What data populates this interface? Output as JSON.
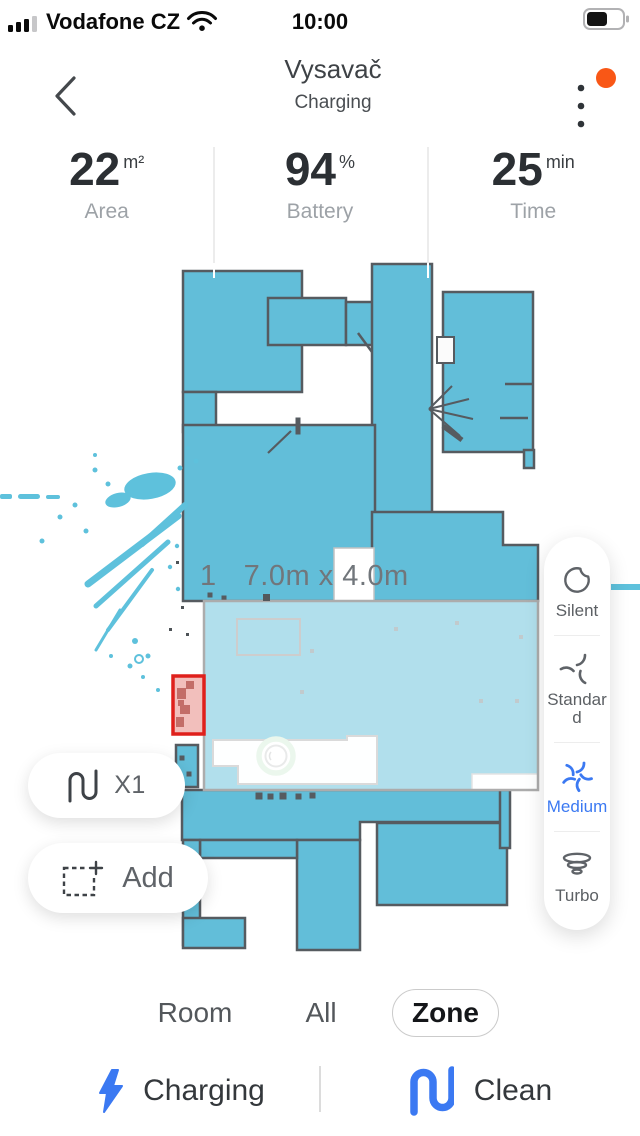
{
  "status_bar": {
    "carrier": "Vodafone CZ",
    "time": "10:00"
  },
  "header": {
    "title": "Vysavač",
    "subtitle": "Charging"
  },
  "stats": {
    "items": [
      {
        "value": "22",
        "unit": "m²",
        "label": "Area"
      },
      {
        "value": "94",
        "unit": "%",
        "label": "Battery"
      },
      {
        "value": "25",
        "unit": "min",
        "label": "Time"
      }
    ]
  },
  "map": {
    "zone_number": "1",
    "zone_size": "7.0m x 4.0m"
  },
  "fan_speed": {
    "options": [
      {
        "label": "Silent"
      },
      {
        "label": "Standard"
      },
      {
        "label": "Medium"
      },
      {
        "label": "Turbo"
      }
    ],
    "selected": "Medium"
  },
  "map_controls": {
    "repeat_label": "X1",
    "add_label": "Add"
  },
  "mode_tabs": {
    "items": [
      {
        "label": "Room"
      },
      {
        "label": "All"
      },
      {
        "label": "Zone"
      }
    ],
    "selected": "Zone"
  },
  "bottom_actions": {
    "charging_label": "Charging",
    "clean_label": "Clean"
  },
  "colors": {
    "map_teal": "#62BED9",
    "map_wall": "#565B60",
    "accent_blue": "#3B79F2",
    "no_go_red": "#DF201C",
    "notification_orange": "#F95716"
  }
}
